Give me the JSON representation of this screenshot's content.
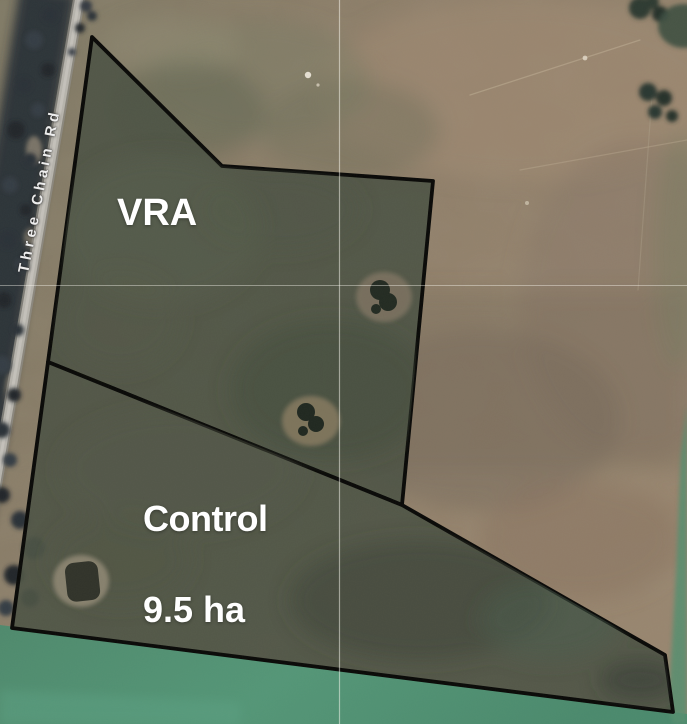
{
  "map": {
    "road_label": "Three Chain Rd",
    "zones": [
      {
        "id": "vra",
        "label": "VRA",
        "points": "92,37 222,166 433,181 402,505 48,362"
      },
      {
        "id": "control",
        "label": "Control",
        "area_label": "9.5 ha",
        "points": "48,362 402,505 665,655 673,712 12,628"
      }
    ],
    "colors": {
      "field_boundary": "#0a0a08",
      "zone_fill": "#4d5345",
      "label_text": "#ffffff",
      "road": "#b6b3ac",
      "paddock_green": "#4f8a6e",
      "dry_grass": "#95836d"
    }
  }
}
